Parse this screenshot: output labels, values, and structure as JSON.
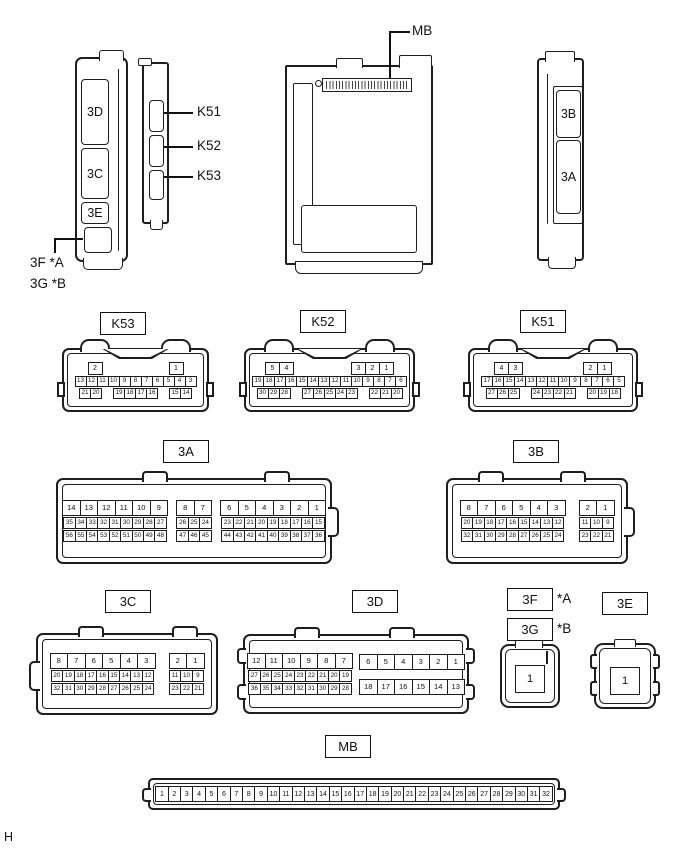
{
  "page": {
    "footer": "H"
  },
  "side_views": {
    "left_unit": {
      "slot_3d": "3D",
      "slot_3c": "3C",
      "slot_3e": "3E",
      "callout_line1": "3F *A",
      "callout_line2": "3G *B"
    },
    "k_unit": {
      "label_k51": "K51",
      "label_k52": "K52",
      "label_k53": "K53"
    },
    "main_unit": {
      "label_mb": "MB"
    },
    "right_unit": {
      "slot_3b": "3B",
      "slot_3a": "3A"
    }
  },
  "faces": {
    "k53": {
      "label": "K53",
      "groups": [
        {
          "rows": [
            {
              "size": "lg",
              "between": true,
              "segs": [
                [
                  "2"
                ],
                [
                  "1"
                ]
              ]
            },
            {
              "size": "sm",
              "segs": [
                [
                  "13",
                  "12",
                  "11",
                  "10",
                  "9",
                  "8",
                  "7",
                  "6",
                  "5",
                  "4",
                  "3"
                ]
              ]
            },
            {
              "size": "sm",
              "segs": [
                [
                  "21",
                  "20"
                ],
                [
                  "19",
                  "18",
                  "17",
                  "16"
                ],
                [
                  "15",
                  "14"
                ]
              ]
            }
          ]
        }
      ]
    },
    "k52": {
      "label": "K52",
      "groups": [
        {
          "rows": [
            {
              "size": "lg",
              "between": true,
              "segs": [
                [
                  "5",
                  "4"
                ],
                [
                  "3",
                  "2",
                  "1"
                ]
              ]
            },
            {
              "size": "sm",
              "segs": [
                [
                  "19",
                  "18",
                  "17",
                  "16",
                  "15",
                  "14",
                  "13",
                  "12",
                  "11",
                  "10",
                  "9",
                  "8",
                  "7",
                  "6"
                ]
              ]
            },
            {
              "size": "sm",
              "segs": [
                [
                  "30",
                  "29",
                  "28"
                ],
                [
                  "27",
                  "26",
                  "25",
                  "24",
                  "23"
                ],
                [
                  "22",
                  "21",
                  "20"
                ]
              ]
            }
          ]
        }
      ]
    },
    "k51": {
      "label": "K51",
      "groups": [
        {
          "rows": [
            {
              "size": "lg",
              "between": true,
              "segs": [
                [
                  "4",
                  "3"
                ],
                [
                  "2",
                  "1"
                ]
              ]
            },
            {
              "size": "sm",
              "segs": [
                [
                  "17",
                  "16",
                  "15",
                  "14",
                  "13",
                  "12",
                  "11",
                  "10",
                  "9",
                  "8",
                  "7",
                  "6",
                  "5"
                ]
              ]
            },
            {
              "size": "sm",
              "segs": [
                [
                  "27",
                  "26",
                  "25"
                ],
                [
                  "24",
                  "23",
                  "22",
                  "21"
                ],
                [
                  "20",
                  "19",
                  "18"
                ]
              ]
            }
          ]
        }
      ]
    },
    "a3": {
      "label": "3A",
      "groups": [
        {
          "rows": [
            {
              "size": "lg",
              "segs": [
                [
                  "14",
                  "13",
                  "12",
                  "11",
                  "10",
                  "9"
                ]
              ]
            },
            {
              "size": "sm",
              "segs": [
                [
                  "35",
                  "34",
                  "33",
                  "32",
                  "31",
                  "30",
                  "29",
                  "28",
                  "27"
                ]
              ]
            },
            {
              "size": "sm",
              "segs": [
                [
                  "56",
                  "55",
                  "54",
                  "53",
                  "52",
                  "51",
                  "50",
                  "49",
                  "48"
                ]
              ]
            }
          ]
        },
        {
          "rows": [
            {
              "size": "lg",
              "segs": [
                [
                  "8",
                  "7"
                ]
              ]
            },
            {
              "size": "sm",
              "segs": [
                [
                  "26",
                  "25",
                  "24"
                ]
              ]
            },
            {
              "size": "sm",
              "segs": [
                [
                  "47",
                  "46",
                  "45"
                ]
              ]
            }
          ]
        },
        {
          "rows": [
            {
              "size": "lg",
              "segs": [
                [
                  "6",
                  "5",
                  "4",
                  "3",
                  "2",
                  "1"
                ]
              ]
            },
            {
              "size": "sm",
              "segs": [
                [
                  "23",
                  "22",
                  "21",
                  "20",
                  "19",
                  "18",
                  "17",
                  "16",
                  "15"
                ]
              ]
            },
            {
              "size": "sm",
              "segs": [
                [
                  "44",
                  "43",
                  "42",
                  "41",
                  "40",
                  "39",
                  "38",
                  "37",
                  "36"
                ]
              ]
            }
          ]
        }
      ]
    },
    "b3": {
      "label": "3B",
      "groups": [
        {
          "rows": [
            {
              "size": "lg",
              "segs": [
                [
                  "8",
                  "7",
                  "6",
                  "5",
                  "4",
                  "3"
                ]
              ]
            },
            {
              "size": "sm",
              "segs": [
                [
                  "20",
                  "19",
                  "18",
                  "17",
                  "16",
                  "15",
                  "14",
                  "13",
                  "12"
                ]
              ]
            },
            {
              "size": "sm",
              "segs": [
                [
                  "32",
                  "31",
                  "30",
                  "29",
                  "28",
                  "27",
                  "26",
                  "25",
                  "24"
                ]
              ]
            }
          ]
        },
        {
          "rows": [
            {
              "size": "lg",
              "segs": [
                [
                  "2",
                  "1"
                ]
              ]
            },
            {
              "size": "sm",
              "segs": [
                [
                  "11",
                  "10",
                  "9"
                ]
              ]
            },
            {
              "size": "sm",
              "segs": [
                [
                  "23",
                  "22",
                  "21"
                ]
              ]
            }
          ]
        }
      ]
    },
    "c3": {
      "label": "3C",
      "groups": [
        {
          "rows": [
            {
              "size": "lg",
              "segs": [
                [
                  "8",
                  "7",
                  "6",
                  "5",
                  "4",
                  "3"
                ]
              ]
            },
            {
              "size": "sm",
              "segs": [
                [
                  "20",
                  "19",
                  "18",
                  "17",
                  "16",
                  "15",
                  "14",
                  "13",
                  "12"
                ]
              ]
            },
            {
              "size": "sm",
              "segs": [
                [
                  "32",
                  "31",
                  "30",
                  "29",
                  "28",
                  "27",
                  "26",
                  "25",
                  "24"
                ]
              ]
            }
          ]
        },
        {
          "rows": [
            {
              "size": "lg",
              "segs": [
                [
                  "2",
                  "1"
                ]
              ]
            },
            {
              "size": "sm",
              "segs": [
                [
                  "11",
                  "10",
                  "9"
                ]
              ]
            },
            {
              "size": "sm",
              "segs": [
                [
                  "23",
                  "22",
                  "21"
                ]
              ]
            }
          ]
        }
      ]
    },
    "d3": {
      "label": "3D",
      "groups": [
        {
          "rows": [
            {
              "size": "lg",
              "segs": [
                [
                  "12",
                  "11",
                  "10",
                  "9",
                  "8",
                  "7"
                ]
              ]
            },
            {
              "size": "sm",
              "segs": [
                [
                  "27",
                  "26",
                  "25",
                  "24",
                  "23",
                  "22",
                  "21",
                  "20",
                  "19"
                ]
              ]
            },
            {
              "size": "sm",
              "segs": [
                [
                  "36",
                  "35",
                  "34",
                  "33",
                  "32",
                  "31",
                  "30",
                  "29",
                  "28"
                ]
              ]
            }
          ]
        },
        {
          "rows": [
            {
              "size": "lg",
              "segs": [
                [
                  "6",
                  "5",
                  "4",
                  "3",
                  "2",
                  "1"
                ]
              ]
            },
            {
              "size": "lg",
              "gap_before": true,
              "segs": [
                [
                  "18",
                  "17",
                  "16",
                  "15",
                  "14",
                  "13"
                ]
              ]
            }
          ]
        }
      ]
    },
    "fg3": {
      "label_f": "3F",
      "suffix_a": "*A",
      "label_g": "3G",
      "suffix_b": "*B",
      "groups": [
        {
          "rows": [
            {
              "size": "xl",
              "segs": [
                [
                  "1"
                ]
              ]
            }
          ]
        }
      ]
    },
    "e3": {
      "label": "3E",
      "groups": [
        {
          "rows": [
            {
              "size": "xl",
              "segs": [
                [
                  "1"
                ]
              ]
            }
          ]
        }
      ]
    },
    "mb": {
      "label": "MB",
      "groups": [
        {
          "rows": [
            {
              "size": "mb",
              "segs": [
                [
                  "1",
                  "2",
                  "3",
                  "4",
                  "5",
                  "6",
                  "7",
                  "8",
                  "9",
                  "10",
                  "11",
                  "12",
                  "13",
                  "14",
                  "15",
                  "16",
                  "17",
                  "18",
                  "19",
                  "20",
                  "21",
                  "22",
                  "23",
                  "24",
                  "25",
                  "26",
                  "27",
                  "28",
                  "29",
                  "30",
                  "31",
                  "32"
                ]
              ]
            }
          ]
        }
      ]
    }
  }
}
